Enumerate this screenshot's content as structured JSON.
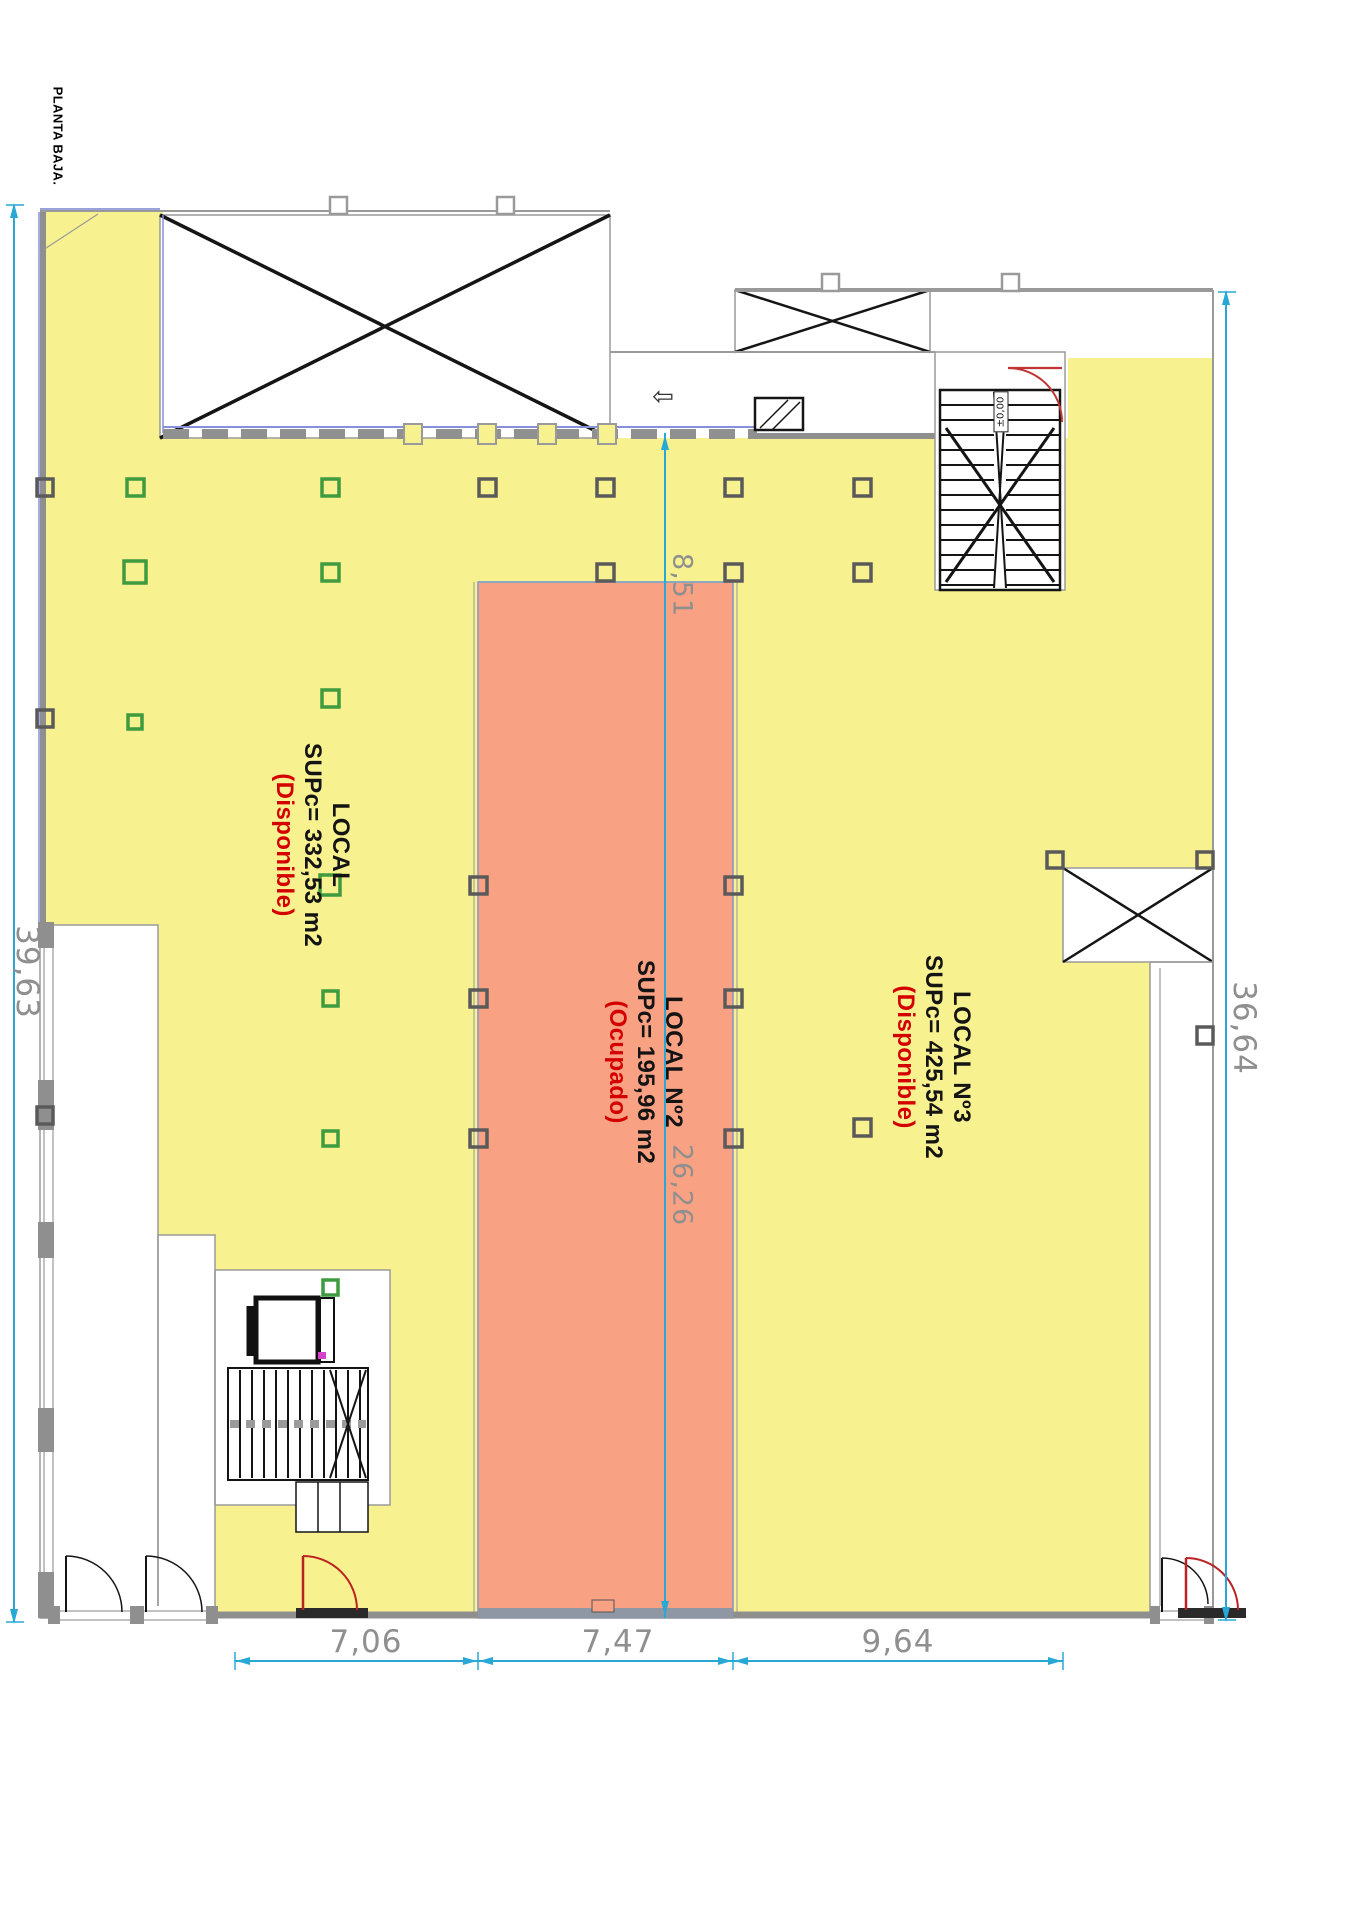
{
  "title": "PLANTA BAJA.",
  "plan": {
    "locals": [
      {
        "name": "LOCAL",
        "area": "SUPc= 332,53 m2",
        "status": "(Disponible)"
      },
      {
        "name": "LOCAL Nº2",
        "area": "SUPc= 195,96 m2",
        "status": "(Ocupado)"
      },
      {
        "name": "LOCAL Nº3",
        "area": "SUPc= 425,54 m2",
        "status": "(Disponible)"
      }
    ],
    "level_marker": "±0,00",
    "dimensions": {
      "left": "39,63",
      "right": "36,64",
      "top": "8,51",
      "center": "26,26",
      "bottom": [
        "7,06",
        "7,47",
        "9,64"
      ]
    }
  },
  "icons": {
    "direction_arrow": "⇦"
  },
  "colors": {
    "available_fill": "#F7F18F",
    "occupied_fill": "#F9A183",
    "dimension_line": "#29A8D6",
    "status_text": "#D40000",
    "green_column": "#3E9B3F",
    "wall_gray": "#8f8f8f"
  }
}
